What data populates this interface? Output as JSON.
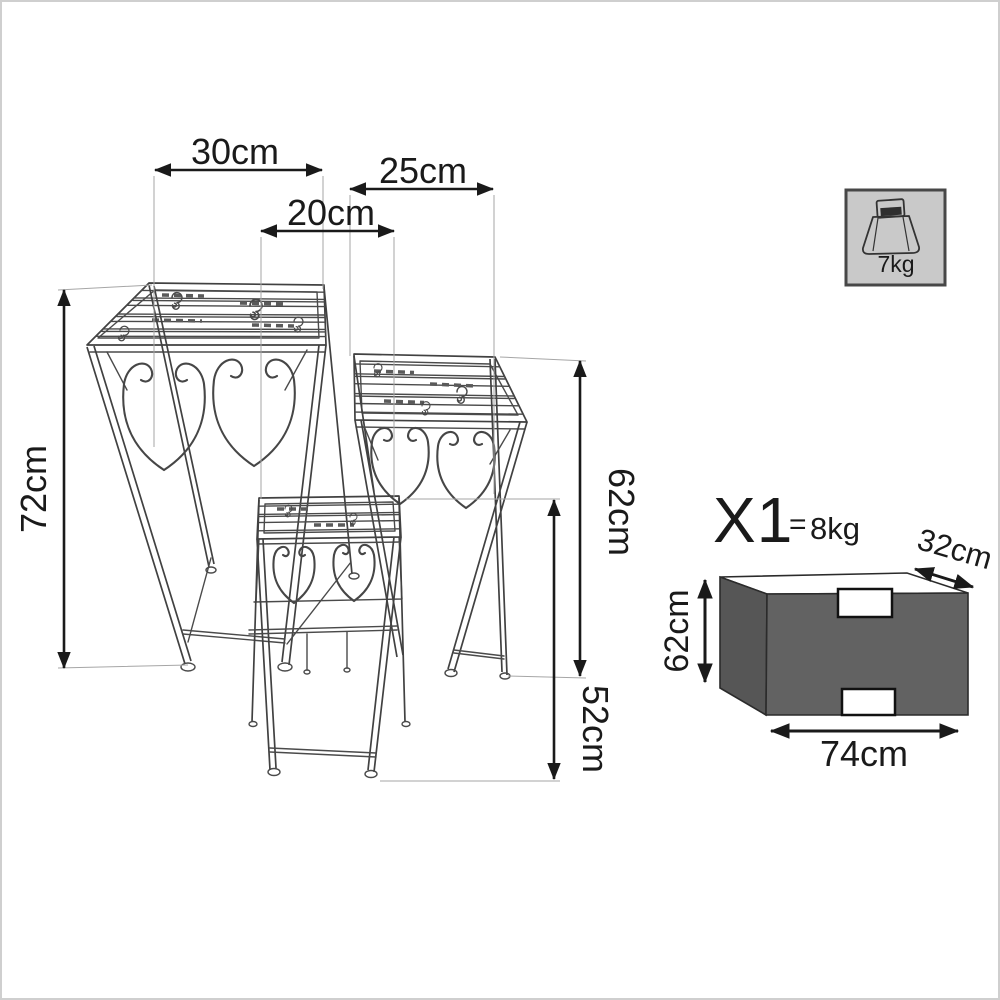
{
  "title": "plant-stand-set-dimension-diagram",
  "stand_dims": {
    "large_width": "30cm",
    "medium_width": "25cm",
    "small_width": "20cm",
    "large_height": "72cm",
    "medium_height": "62cm",
    "small_height": "52cm"
  },
  "capacity_badge": {
    "max_load": "7kg",
    "icon": "scale-weight-icon"
  },
  "package": {
    "quantity": "X1",
    "equals": "=",
    "weight": "8kg",
    "depth": "32cm",
    "height": "62cm",
    "width": "74cm"
  },
  "colors": {
    "outline": "#4a4a4a",
    "dimension": "#1a1a1a",
    "extension": "#a6a6a6",
    "badge_bg": "#c9c9c9",
    "badge_border": "#474747",
    "package_top": "#ffffff",
    "package_side": "#565656",
    "package_front": "#626262",
    "handle_fill": "#ffffff"
  }
}
